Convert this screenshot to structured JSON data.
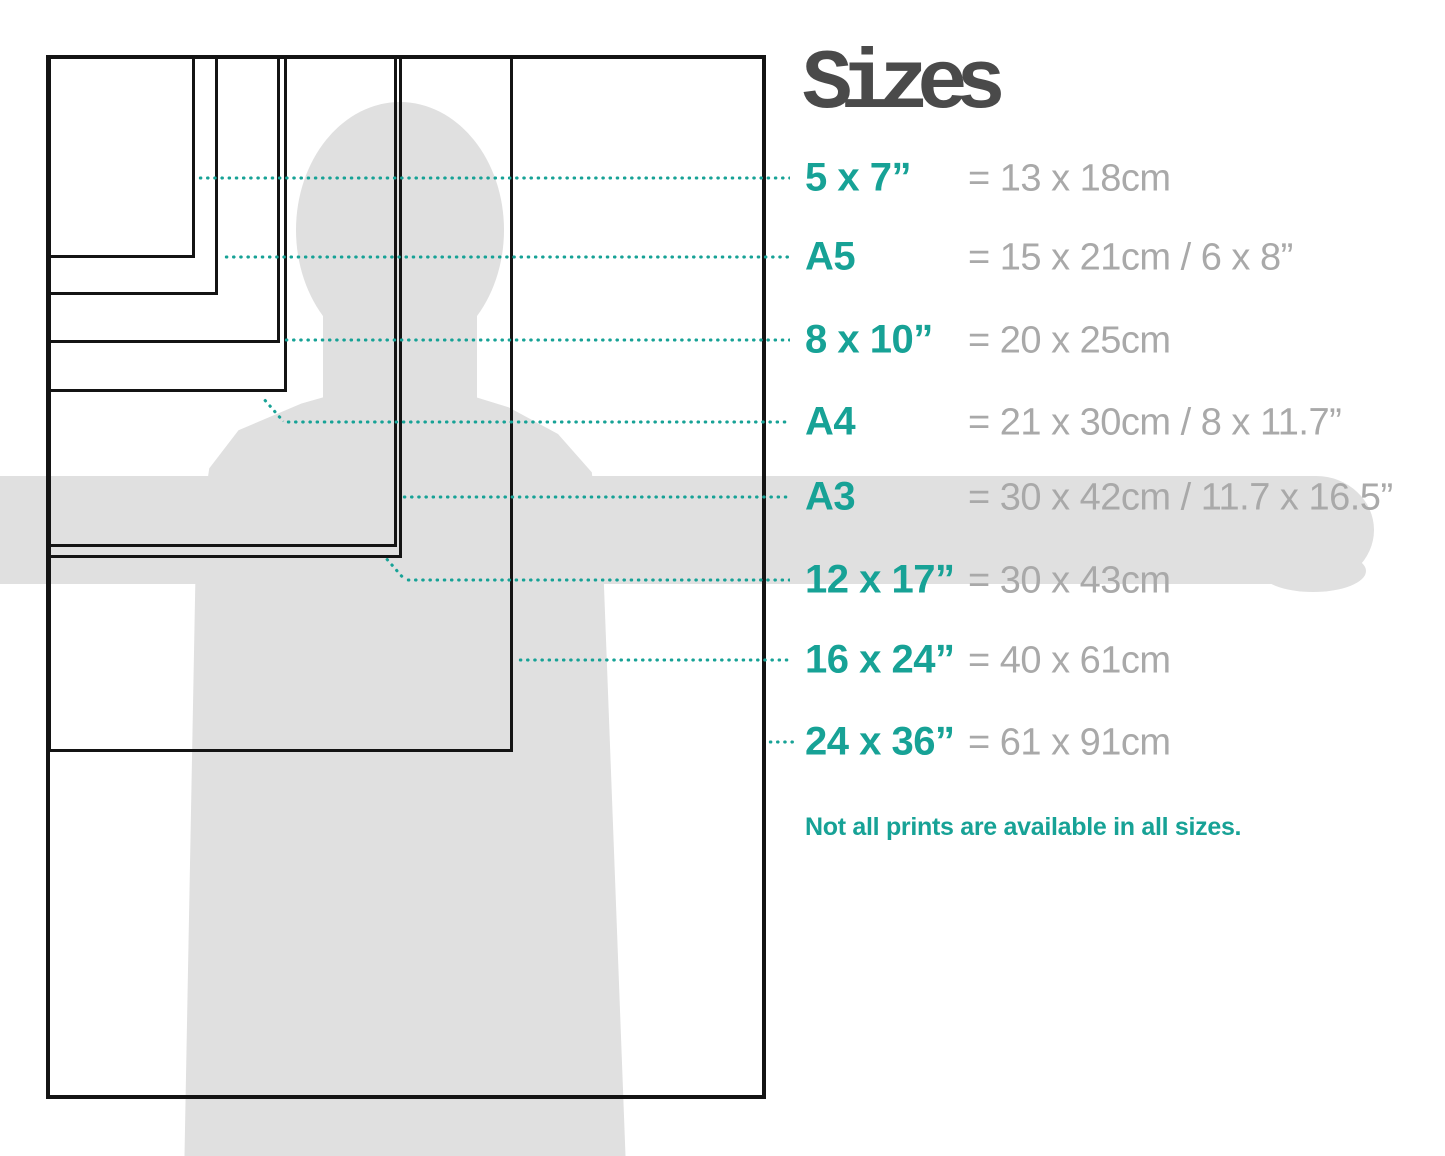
{
  "title": "Sizes",
  "rows": [
    {
      "label": "5 x 7”",
      "value": "= 13 x 18cm"
    },
    {
      "label": "A5",
      "value": "= 15 x 21cm / 6 x 8”"
    },
    {
      "label": "8 x 10”",
      "value": "= 20 x 25cm"
    },
    {
      "label": "A4",
      "value": "= 21 x 30cm / 8 x 11.7”"
    },
    {
      "label": "A3",
      "value": "= 30 x 42cm / 11.7 x 16.5”"
    },
    {
      "label": "12 x 17”",
      "value": "= 30 x 43cm"
    },
    {
      "label": "16 x 24”",
      "value": "= 40 x 61cm"
    },
    {
      "label": "24 x 36”",
      "value": "= 61 x 91cm"
    }
  ],
  "note": "Not all prints are available in all sizes.",
  "colors": {
    "accent": "#17a296",
    "value_text": "#a9a9a9",
    "title_text": "#4a4a4a",
    "silhouette": "#e0e0e0",
    "outline": "#141414"
  }
}
